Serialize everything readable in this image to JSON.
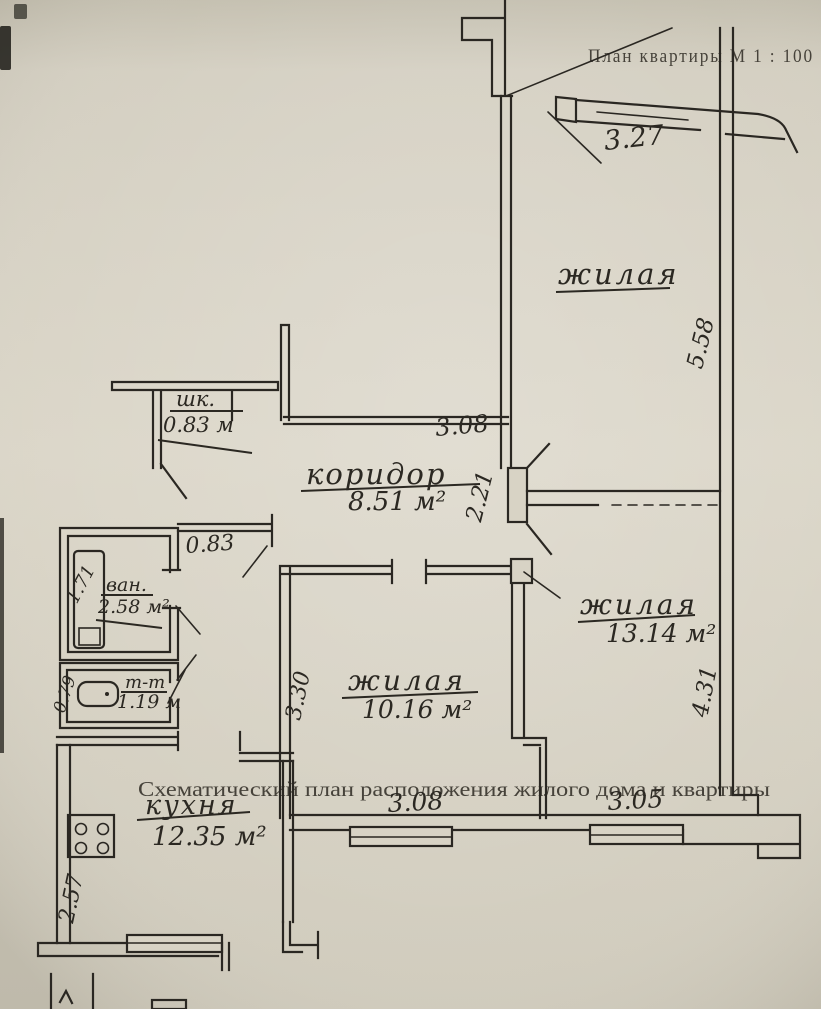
{
  "header": {
    "plan_title": "План квартиры  М 1 : 100"
  },
  "caption": {
    "text": "Схематический план расположения жилого дома и квартиры"
  },
  "rooms": {
    "living_top": {
      "name": "жилая"
    },
    "living_mid": {
      "name": "жилая",
      "area": "10.16 м²"
    },
    "living_right": {
      "name": "жилая",
      "area": "13.14 м²"
    },
    "corridor": {
      "name": "коридор",
      "area": "8.51 м²"
    },
    "kitchen": {
      "name": "кухня",
      "area": "12.35 м²"
    },
    "bathroom": {
      "name": "ван.",
      "area": "2.58 м²"
    },
    "toilet": {
      "name": "т-т",
      "area": "1.19 м"
    },
    "closet": {
      "name": "шк.",
      "area": "0.83 м"
    }
  },
  "dims": {
    "top_window": "3.27",
    "living_top_h": "5.58",
    "corridor_top": "3.08",
    "door_right": "2.21",
    "vestibule": "0.83",
    "bath_h": "1.71",
    "toilet_h": "0.79",
    "mid_h": "3.30",
    "right_h": "4.31",
    "kitchen_h": "2.57",
    "bottom_mid": "3.08",
    "bottom_right": "3.05"
  },
  "colors": {
    "ink": "#2a2722",
    "paper": "#d6d1c3"
  },
  "icons": {
    "bathtub": "bathtub-icon",
    "toilet": "toilet-bowl-icon",
    "stove": "stove-burners-icon"
  }
}
